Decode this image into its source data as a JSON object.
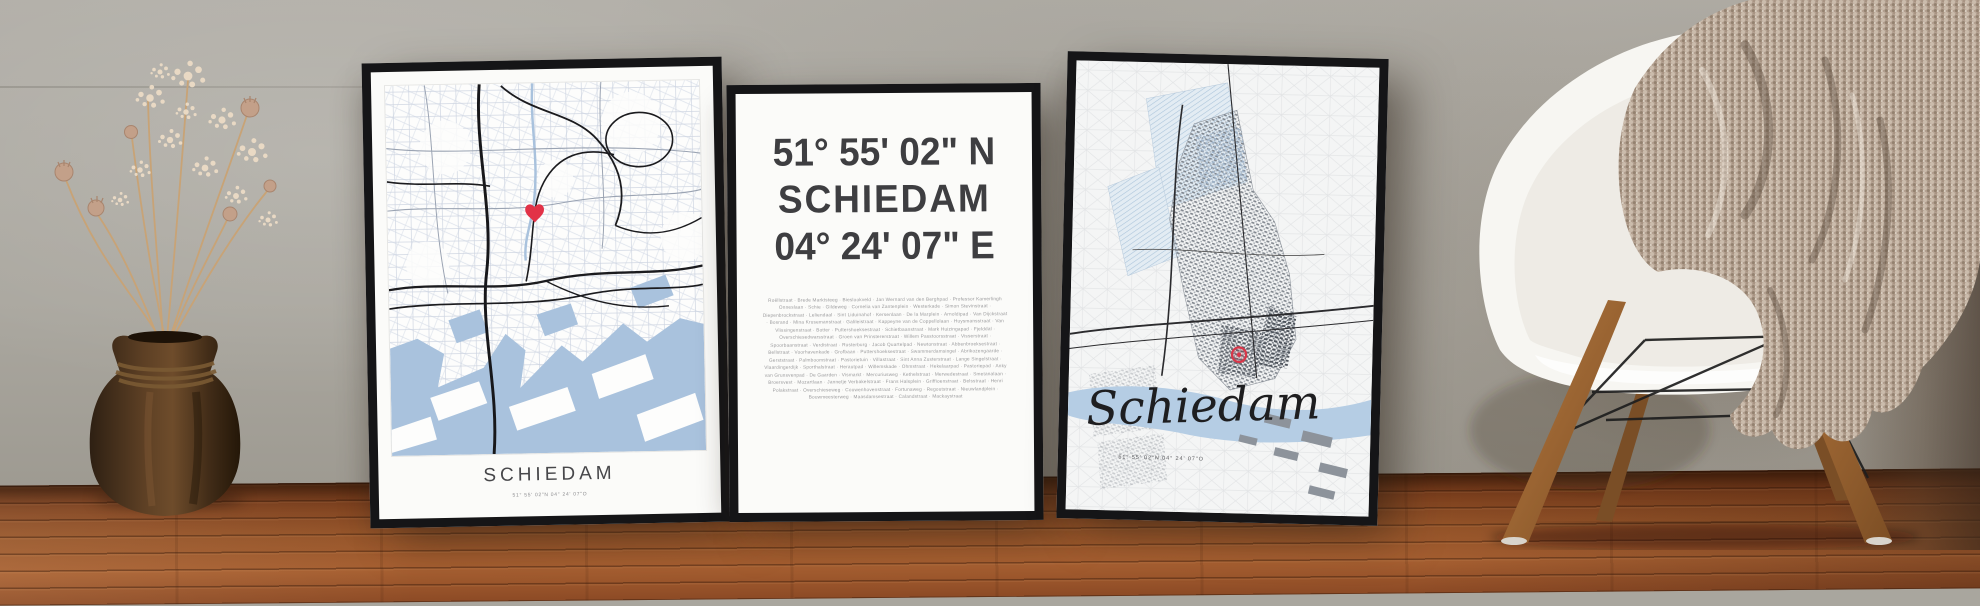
{
  "posters": {
    "left": {
      "title": "SCHIEDAM",
      "subtitle": "51° 55' 02\"N 04° 24' 07\"O",
      "marker_icon": "red-heart-icon",
      "style": "white street map with blue water and black roads"
    },
    "middle": {
      "latitude": "51° 55' 02\" N",
      "city": "SCHIEDAM",
      "longitude": "04° 24' 07\" E",
      "separator": "·",
      "street_names": [
        "Roëllstraat",
        "Brede Marktsteeg",
        "Bieslookveld",
        "Jan Wernard van den Berghpad",
        "Professor Kamerlingh Onneslaan",
        "Schie",
        "Gildeweg",
        "Cornelia van Zantenplein",
        "Westerkade",
        "Simon Stevinstraat",
        "Diepenbrockstraat",
        "Leliendaal",
        "Sint Liduinahof",
        "Kersenlaan",
        "De la Marplein",
        "Arnoldipad",
        "Van Dijckstraat",
        "Bosrand",
        "Mina Krusemanstraat",
        "Galileistraat",
        "Kappeyne van de Coppellolaan",
        "Huysmansstraat",
        "Van Vlissingenstraat",
        "Botter",
        "Puttershoeksestraat",
        "Schietbaanstraat",
        "Mark Huizingapad",
        "Fjelddal",
        "Overschiesedwarsstraat",
        "Groen van Prinstererstraat",
        "Willem Passtoorsstraat",
        "Visserstraat",
        "Spoorbaanstraat",
        "Verdistraat",
        "Rusterburg",
        "Jacob Quartelpad",
        "Newtonstraat",
        "Abbenbroeksestraat",
        "Bellstraat",
        "Voorhavenkade",
        "Grofbaan",
        "Puttershoeksestraat",
        "Swammerdamsingel",
        "Abrikozengaarde",
        "Gerststraat",
        "Palmboomstraat",
        "Pastorietuin",
        "Villastraat",
        "Sint Anna Zusterstraat",
        "Lange Singelstraat",
        "Vlaardingerdijk",
        "Sporthalstraat",
        "Herautpad",
        "Willemskade",
        "Ohmstraat",
        "Hekelaarpad",
        "Pastoriepad",
        "Anky van Grunsvenpad",
        "De Gaarden",
        "Vismarkt",
        "Mercuriusweg",
        "Kethelstraat",
        "Merwedestraat",
        "Smetanalaan",
        "Broersvest",
        "Mozartlaan",
        "Jannetje Verbakelstraat",
        "Frans Halsplein",
        "Griffioenstraat",
        "Belsstraat",
        "Henri Polakstraat",
        "Overschieseweg",
        "Couwenhovenstraat",
        "Fortunaweg",
        "Regoutstraat",
        "Nieuwlandplein",
        "Bouwmeesterweg",
        "Maasdamsestraat",
        "Calandstraat",
        "Mackaystraat"
      ]
    },
    "right": {
      "title": "Schiedam",
      "subtitle": "51° 55' 02\"N 04° 24' 07\"O",
      "marker_icon": "red-location-circle-icon",
      "style": "light topographic map with highlighted municipality"
    }
  },
  "colors": {
    "frame": "#151517",
    "paper": "#fbfbf9",
    "map_water_blue": "#a9c2dd",
    "map_road_black": "#1b1b1e",
    "map_minor_street": "#c6cedd",
    "marker_red": "#e23247",
    "wall_gray": "#aaa79f",
    "floor_wood": "#955429",
    "chair_shell_white": "#f7f6f2",
    "chair_leg_wood": "#a06a38",
    "blanket_taupe": "#b3a090",
    "dried_flowers": "#e9d8c3",
    "vase_brown": "#4a3categories"
  }
}
